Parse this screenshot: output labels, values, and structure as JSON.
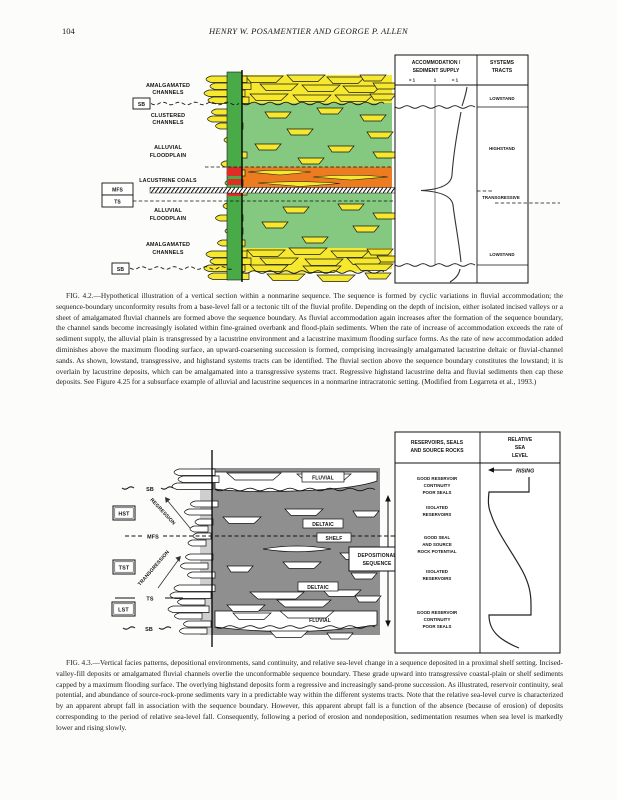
{
  "page": {
    "number": "104",
    "running_head": "HENRY W. POSAMENTIER AND GEORGE P. ALLEN"
  },
  "fig42": {
    "left": {
      "amalg1a": "AMALGAMATED",
      "amalg1b": "CHANNELS",
      "sb1": "SB",
      "clus_a": "CLUSTERED",
      "clus_b": "CHANNELS",
      "allu1a": "ALLUVIAL",
      "allu1b": "FLOODPLAIN",
      "lac": "LACUSTRINE COALS",
      "mfs": "MFS",
      "ts": "TS",
      "allu2a": "ALLUVIAL",
      "allu2b": "FLOODPLAIN",
      "amalg2a": "AMALGAMATED",
      "amalg2b": "CHANNELS",
      "sb2": "SB"
    },
    "table": {
      "acc1": "ACCOMMODATION /",
      "acc2": "SEDIMENT SUPPLY",
      "tick_gt": "> 1",
      "tick_eq": "1",
      "tick_lt": "< 1",
      "st1": "SYSTEMS",
      "st2": "TRACTS",
      "lowstand_top": "LOWSTAND",
      "highstand": "HIGHSTAND",
      "transgressive": "TRANSGRESSIVE",
      "lowstand_bot": "LOWSTAND"
    },
    "colors": {
      "channel_yellow": "#f6e82e",
      "floodplain_green": "#85c87f",
      "section_green": "#48ab47",
      "lacustrine_orange": "#ed7c21",
      "coal_red": "#e02b26"
    },
    "caption": "FIG. 4.2.—Hypothetical illustration of a vertical section within a nonmarine sequence. The sequence is formed by cyclic variations in fluvial accommodation; the sequence-boundary unconformity results from a base-level fall or a tectonic tilt of the fluvial profile. Depending on the depth of incision, either isolated incised valleys or a sheet of amalgamated fluvial channels are formed above the sequence boundary. As fluvial accommodation again increases after the formation of the sequence boundary, the channel sands become increasingly isolated within fine-grained overbank and flood-plain sediments. When the rate of increase of accommodation exceeds the rate of sediment supply, the alluvial plain is transgressed by a lacustrine environment and a lacustrine maximum flooding surface forms. As the rate of new accommodation added diminishes above the maximum flooding surface, an upward-coarsening succession is formed, comprising increasingly amalgamated lacustrine deltaic or fluvial-channel sands. As shown, lowstand, transgressive, and highstand systems tracts can be identified. The fluvial section above the sequence boundary constitutes the lowstand; it is overlain by lacustrine deposits, which can be amalgamated into a transgressive systems tract. Regressive highstand lacustrine delta and fluvial sediments then cap these deposits. See Figure 4.25 for a subsurface example of alluvial and lacustrine sequences in a nonmarine intracratonic setting. (Modified from Legarreta et al., 1993.)"
  },
  "fig43": {
    "left": {
      "sb_top": "SB",
      "hst": "HST",
      "regression": "REGRESSION",
      "mfs": "MFS",
      "tst": "TST",
      "transgression": "TRANSGRESSION",
      "ts": "TS",
      "lst": "LST",
      "sb_bot": "SB"
    },
    "panel": {
      "fluvial_top": "FLUVIAL",
      "deltaic_up": "DELTAIC",
      "shelf": "SHELF",
      "deltaic_lo": "DELTAIC",
      "fluvial_bot": "FLUVIAL"
    },
    "depseq1": "DEPOSITIONAL",
    "depseq2": "SEQUENCE",
    "table": {
      "col1a": "RESERVOIRS, SEALS",
      "col1b": "AND SOURCE ROCKS",
      "col2a": "RELATIVE",
      "col2b": "SEA",
      "col2c": "LEVEL",
      "rising": "RISING",
      "e1a": "GOOD RESERVOIR",
      "e1b": "CONTINUITY",
      "e1c": "POOR SEALS",
      "e2a": "ISOLATED",
      "e2b": "RESERVOIRS",
      "e3a": "GOOD SEAL",
      "e3b": "AND SOURCE",
      "e3c": "ROCK POTENTIAL",
      "e4a": "ISOLATED",
      "e4b": "RESERVOIRS",
      "e5a": "GOOD RESERVOIR",
      "e5b": "CONTINUITY",
      "e5c": "POOR SEALS"
    },
    "caption": "FIG. 4.3.—Vertical facies patterns, depositional environments, sand continuity, and relative sea-level change in a sequence deposited in a proximal shelf setting. Incised-valley-fill deposits or amalgamated fluvial channels overlie the unconformable sequence boundary. These grade upward into transgressive coastal-plain or shelf sediments capped by a maximum flooding surface. The overlying highstand deposits form a regressive and increasingly sand-prone succession. As illustrated, reservoir continuity, seal potential, and abundance of source-rock-prone sediments vary in a predictable way within the different systems tracts. Note that the relative sea-level curve is characterized by an apparent abrupt fall in association with the sequence boundary. However, this apparent abrupt fall is a function of the absence (because of erosion) of deposits corresponding to the period of relative sea-level fall. Consequently, following a period of erosion and nondeposition, sedimentation resumes when sea level is markedly lower and rising slowly."
  }
}
